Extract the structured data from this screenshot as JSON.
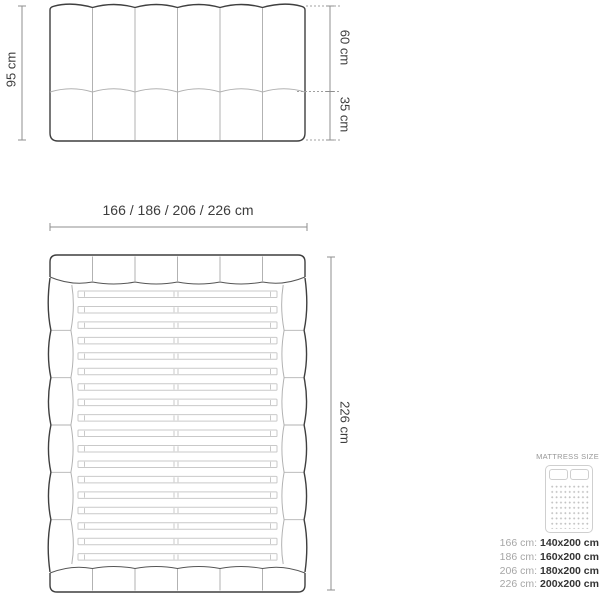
{
  "front_view": {
    "height_total_label": "95 cm",
    "height_upper_label": "60 cm",
    "height_lower_label": "35 cm"
  },
  "top_view": {
    "width_options_label": "166 / 186 / 206 / 226 cm",
    "length_label": "226 cm"
  },
  "legend": {
    "title": "MATTRESS SIZE",
    "icon": "mattress-top-view-icon",
    "rows": [
      {
        "frame_width": "166 cm:",
        "mattress_size": "140x200 cm"
      },
      {
        "frame_width": "186 cm:",
        "mattress_size": "160x200 cm"
      },
      {
        "frame_width": "206 cm:",
        "mattress_size": "180x200 cm"
      },
      {
        "frame_width": "226 cm:",
        "mattress_size": "200x200 cm"
      }
    ]
  },
  "colors": {
    "outline_dark": "#3f3f3f",
    "dimension_line": "#8f8f8f",
    "leader_dotted": "#a0a0a0",
    "panel_seam_light": "#b2b2b2",
    "slat_line": "#c9c9c9",
    "text_dark": "#3d3d3d",
    "text_gray": "#979797",
    "legend_value": "#333333"
  }
}
